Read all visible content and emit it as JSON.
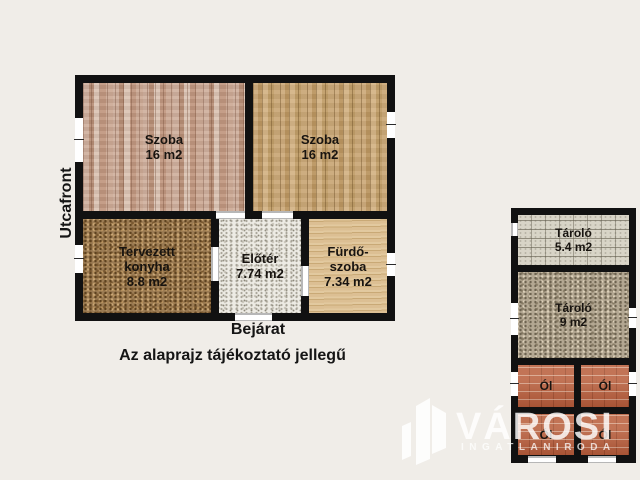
{
  "main_plan": {
    "street_front_label": "Utcafront",
    "entrance_label": "Bejárat",
    "disclaimer": "Az alaprajz tájékoztató jellegű",
    "rooms": {
      "szoba_left": {
        "name": "Szoba",
        "area": "16 m2"
      },
      "szoba_right": {
        "name": "Szoba",
        "area": "16 m2"
      },
      "konyha": {
        "name_line1": "Tervezett",
        "name_line2": "konyha",
        "area": "8.8 m2"
      },
      "eloter": {
        "name": "Előtér",
        "area": "7.74 m2"
      },
      "furdo": {
        "name_line1": "Fürdő-",
        "name_line2": "szoba",
        "area": "7.34 m2"
      }
    }
  },
  "outbuilding": {
    "rooms": {
      "tarolo_small": {
        "name": "Tároló",
        "area": "5.4 m2"
      },
      "tarolo_large": {
        "name": "Tároló",
        "area": "9 m2"
      },
      "pen1": {
        "name": "Ól"
      },
      "pen2": {
        "name": "Ól"
      },
      "pen3": {
        "name": "Ól"
      },
      "pen4": {
        "name": "Ól"
      }
    }
  },
  "watermark": {
    "brand": "VÁROSI",
    "subtitle": "INGATLANIRODA",
    "icon": "buildings-icon",
    "color": "#ffffff"
  },
  "colors": {
    "background": "#f0ede8",
    "wall": "#111111",
    "brick": "#b45c3c"
  }
}
